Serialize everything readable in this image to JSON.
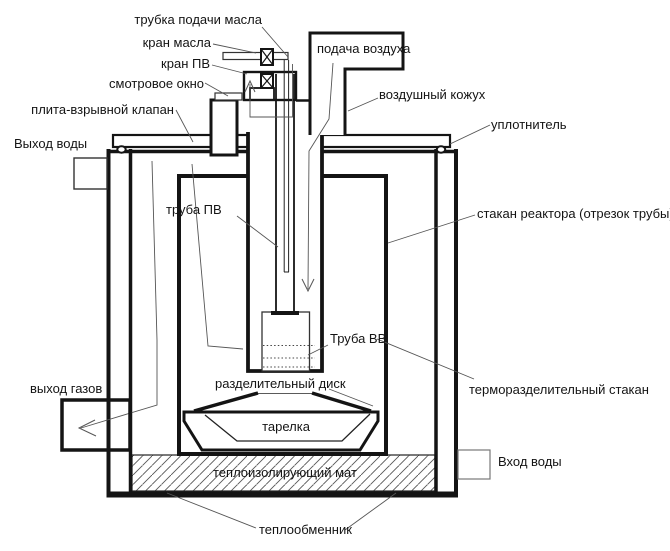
{
  "diagram": {
    "type": "technical-schematic",
    "subject": "reactor vessel cross-section",
    "line_color": "#141414",
    "background_color": "#ffffff",
    "labels": {
      "oil_supply_tube": "трубка подачи масла",
      "oil_valve": "кран масла",
      "pv_valve": "кран ПВ",
      "sight_window": "смотровое окно",
      "explosion_plate": "плита-взрывной клапан",
      "water_outlet": "Выход воды",
      "air_supply": "подача воздуха",
      "air_casing": "воздушный кожух",
      "seal": "уплотнитель",
      "pv_pipe": "труба ПВ",
      "reactor_cup": "стакан реактора (отрезок трубы)",
      "bb_pipe": "Труба ВВ",
      "gas_outlet": "выход газов",
      "separating_disk": "разделительный диск",
      "thermal_separating_cup": "терморазделительный стакан",
      "dish": "тарелка",
      "insulating_mat": "теплоизолирующий мат",
      "water_inlet": "Вход воды",
      "heat_exchanger": "теплообменник"
    }
  }
}
